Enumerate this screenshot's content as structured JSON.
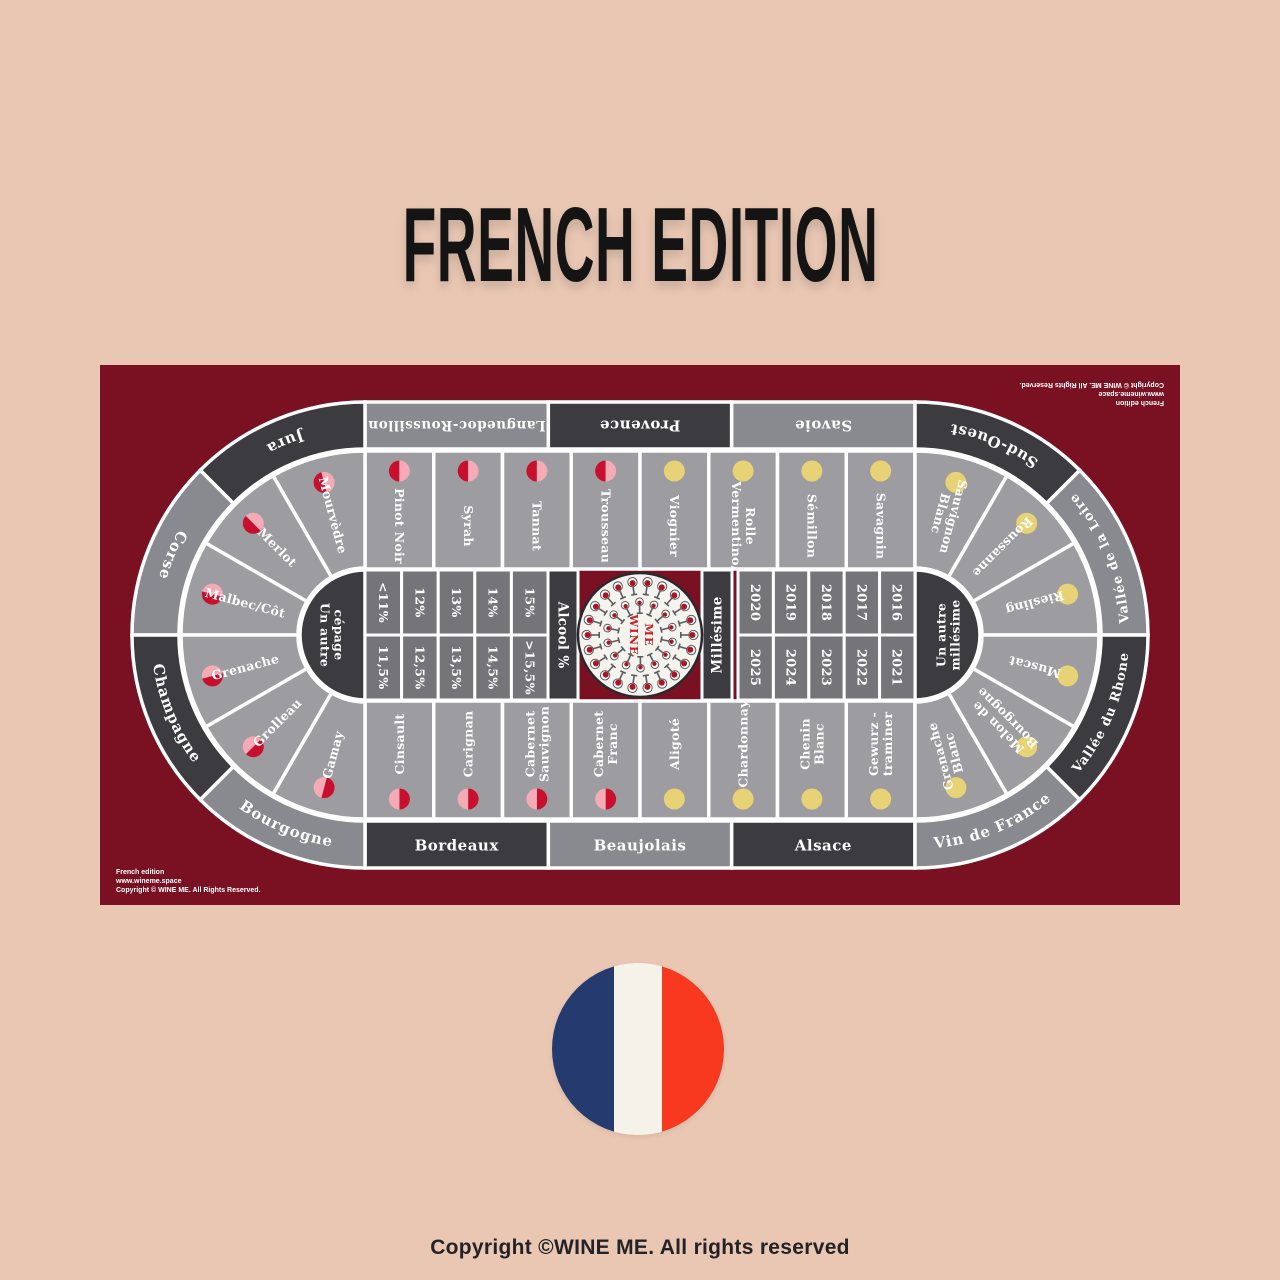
{
  "page": {
    "title": "FRENCH EDITION",
    "footer": "Copyright ©WINE ME. All rights reserved"
  },
  "colors": {
    "page_bg": "#e9c7b3",
    "board_bg": "#7a1123",
    "dark_segment": "#3c3c40",
    "light_segment": "#898a8f",
    "cell": "#9d9da1",
    "inner_cell": "#757579",
    "separator": "#ffffff",
    "red_icon": "#c8102e",
    "pink_icon": "#f4abb5",
    "yellow_icon": "#e8d276",
    "wine_red": "#b11226",
    "glass_outline": "#5c5c60",
    "logo_red": "#cc2027",
    "flag_blue": "#253a6e",
    "flag_white": "#f5f2ea",
    "flag_red": "#f8381f"
  },
  "board": {
    "credit_lines": [
      "French edition",
      "www.wineme.space",
      "Copyright © WINE ME. All Rights Reserved."
    ],
    "center_logo": [
      "WINE",
      "ME"
    ],
    "alcohol_band": "Alcool %",
    "vintage_band": "Millésime",
    "other_grape": [
      "Un autre",
      "cépage"
    ],
    "other_vintage": [
      "Un autre",
      "millésime"
    ],
    "alcohol_top": [
      "<11%",
      "12%",
      "13%",
      "14%",
      "15%"
    ],
    "alcohol_bottom": [
      "11,5%",
      "12,5%",
      "13,5%",
      "14,5%",
      ">15,5%"
    ],
    "years_top": [
      "2020",
      "2019",
      "2018",
      "2017",
      "2016"
    ],
    "years_bottom": [
      "2025",
      "2024",
      "2023",
      "2022",
      "2021"
    ],
    "regions_top": [
      {
        "label": "Languedoc-Roussillon",
        "dark": false
      },
      {
        "label": "Provence",
        "dark": true
      },
      {
        "label": "Savoie",
        "dark": false
      }
    ],
    "regions_bottom": [
      {
        "label": "Bordeaux",
        "dark": true
      },
      {
        "label": "Beaujolais",
        "dark": false
      },
      {
        "label": "Alsace",
        "dark": true
      }
    ],
    "regions_left_arc": [
      {
        "label": "Jura",
        "dark": true
      },
      {
        "label": "Corse",
        "dark": false
      },
      {
        "label": "Champagne",
        "dark": true
      },
      {
        "label": "Bourgogne",
        "dark": false
      }
    ],
    "regions_right_arc": [
      {
        "label": "Sud-Ouest",
        "dark": true
      },
      {
        "label": "Vallée de la Loire",
        "dark": false
      },
      {
        "label": "Vallée du Rhone",
        "dark": true
      },
      {
        "label": "Vin de France",
        "dark": false
      }
    ],
    "grapes_top": [
      {
        "lines": [
          "Pinot Noir"
        ],
        "type": "red"
      },
      {
        "lines": [
          "Syrah"
        ],
        "type": "red"
      },
      {
        "lines": [
          "Tannat"
        ],
        "type": "red"
      },
      {
        "lines": [
          "Trousseau"
        ],
        "type": "red"
      },
      {
        "lines": [
          "Viognier"
        ],
        "type": "white"
      },
      {
        "lines": [
          "Vermentino/",
          "Rolle"
        ],
        "type": "white"
      },
      {
        "lines": [
          "Sémillon"
        ],
        "type": "white"
      },
      {
        "lines": [
          "Savagnin"
        ],
        "type": "white"
      }
    ],
    "grapes_bottom": [
      {
        "lines": [
          "Cinsault"
        ],
        "type": "red"
      },
      {
        "lines": [
          "Carignan"
        ],
        "type": "red"
      },
      {
        "lines": [
          "Cabernet",
          "Sauvignon"
        ],
        "type": "red"
      },
      {
        "lines": [
          "Cabernet",
          "Franc"
        ],
        "type": "red"
      },
      {
        "lines": [
          "Aligoté"
        ],
        "type": "white"
      },
      {
        "lines": [
          "Chardonnay"
        ],
        "type": "white"
      },
      {
        "lines": [
          "Chenin",
          "Blanc"
        ],
        "type": "white"
      },
      {
        "lines": [
          "Gewurz -",
          "traminer"
        ],
        "type": "white"
      }
    ],
    "grapes_left_arc": [
      {
        "lines": [
          "Mourvèdre"
        ],
        "type": "red"
      },
      {
        "lines": [
          "Merlot"
        ],
        "type": "red"
      },
      {
        "lines": [
          "Malbec/Côt"
        ],
        "type": "red"
      },
      {
        "lines": [
          "Grenache"
        ],
        "type": "red"
      },
      {
        "lines": [
          "Grolleau"
        ],
        "type": "red"
      },
      {
        "lines": [
          "Gamay"
        ],
        "type": "red"
      }
    ],
    "grapes_right_arc": [
      {
        "lines": [
          "Sauvignon",
          "Blanc"
        ],
        "type": "white"
      },
      {
        "lines": [
          "Roussanne"
        ],
        "type": "white"
      },
      {
        "lines": [
          "Riesling"
        ],
        "type": "white"
      },
      {
        "lines": [
          "Muscat"
        ],
        "type": "white"
      },
      {
        "lines": [
          "Melon de",
          "Bourgogne"
        ],
        "type": "white"
      },
      {
        "lines": [
          "Grenache",
          "Blanc"
        ],
        "type": "white"
      }
    ]
  }
}
